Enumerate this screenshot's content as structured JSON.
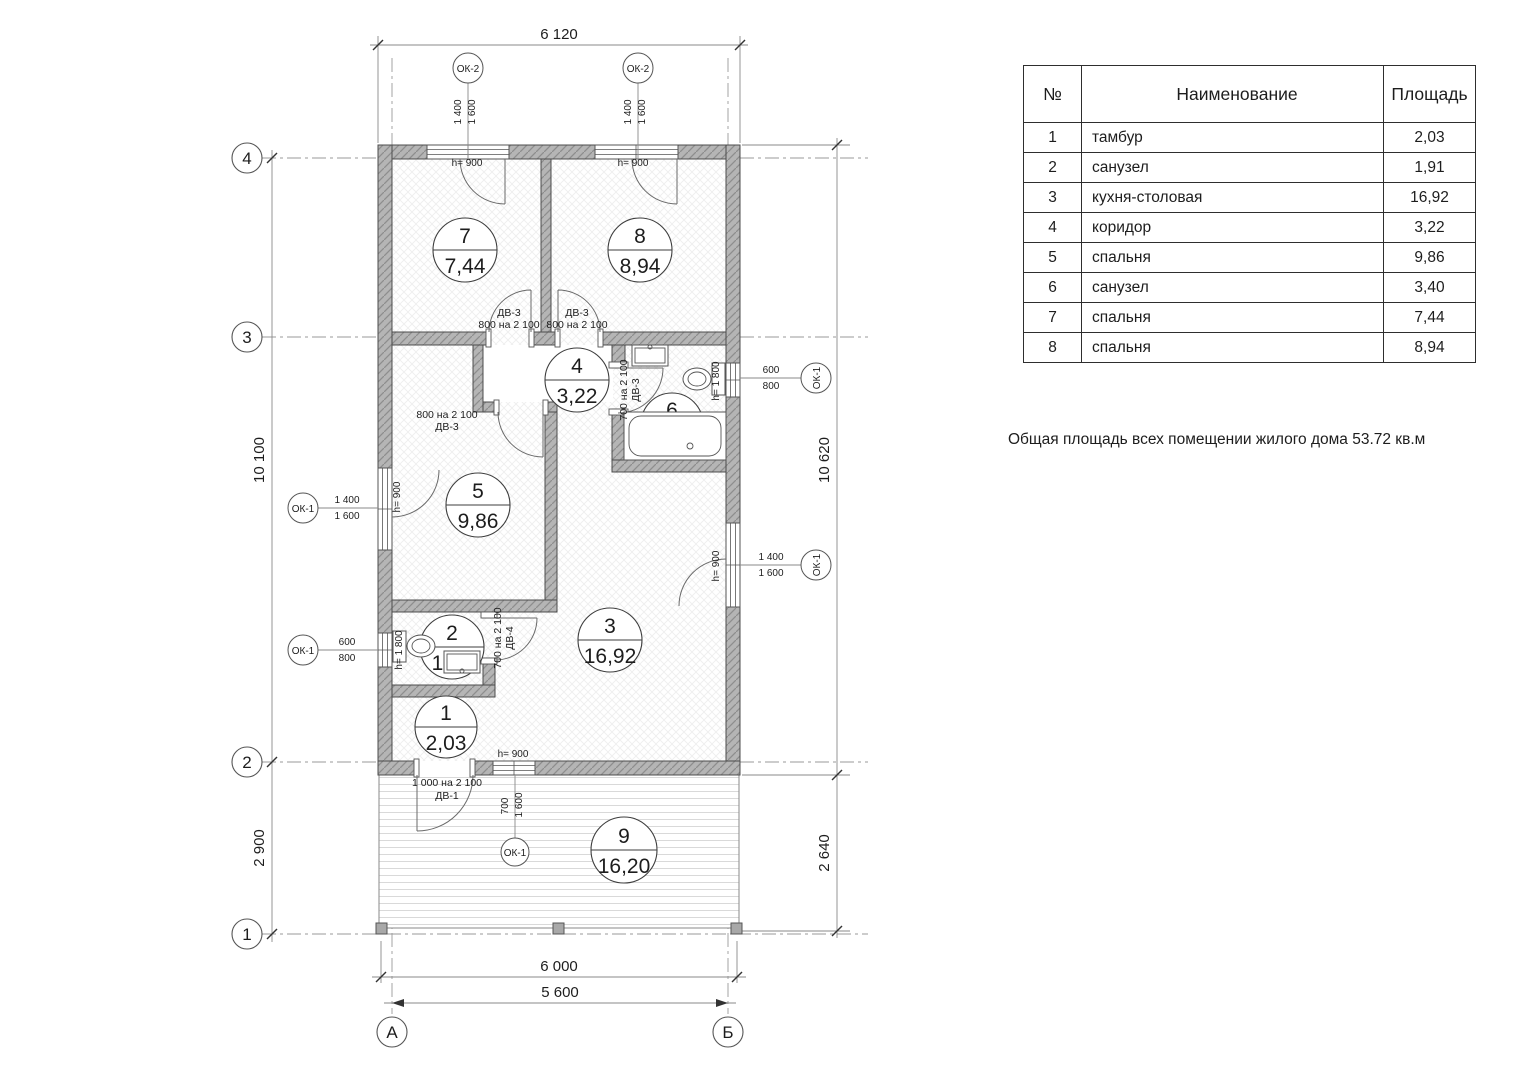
{
  "plan": {
    "dims": {
      "top": "6 120",
      "left_upper": "10 100",
      "left_lower": "2 900",
      "right_upper": "10 620",
      "right_lower": "2 640",
      "bottom_outer": "6 000",
      "bottom_inner": "5 600"
    },
    "axes": {
      "a4": "4",
      "a3": "3",
      "a2": "2",
      "a1": "1",
      "aA": "А",
      "aB": "Б"
    },
    "rooms": {
      "r1": {
        "num": "1",
        "area": "2,03"
      },
      "r2": {
        "num": "2",
        "area": "1,91"
      },
      "r3": {
        "num": "3",
        "area": "16,92"
      },
      "r4": {
        "num": "4",
        "area": "3,22"
      },
      "r5": {
        "num": "5",
        "area": "9,86"
      },
      "r6": {
        "num": "6",
        "area": "3,40"
      },
      "r7": {
        "num": "7",
        "area": "7,44"
      },
      "r8": {
        "num": "8",
        "area": "8,94"
      },
      "r9": {
        "num": "9",
        "area": "16,20"
      }
    },
    "windows": {
      "ok1": "ОК-1",
      "ok2": "ОК-2",
      "w1400": "1 400",
      "w1600": "1 600",
      "w600": "600",
      "w800": "800",
      "w700": "700"
    },
    "sills": {
      "h900": "h= 900",
      "h1800": "h= 1 800"
    },
    "doors": {
      "dv1": "ДВ-1",
      "dv3": "ДВ-3",
      "dv4": "ДВ-4",
      "s800": "800 на 2 100",
      "s700": "700 на 2 100",
      "s1000": "1 000 на 2 100"
    }
  },
  "table": {
    "headers": [
      "№",
      "Наименование",
      "Площадь"
    ],
    "rows": [
      [
        "1",
        "тамбур",
        "2,03"
      ],
      [
        "2",
        "санузел",
        "1,91"
      ],
      [
        "3",
        "кухня-столовая",
        "16,92"
      ],
      [
        "4",
        "коридор",
        "3,22"
      ],
      [
        "5",
        "спальня",
        "9,86"
      ],
      [
        "6",
        "санузел",
        "3,40"
      ],
      [
        "7",
        "спальня",
        "7,44"
      ],
      [
        "8",
        "спальня",
        "8,94"
      ]
    ]
  },
  "summary": "Общая площадь всех помещении жилого дома 53.72 кв.м"
}
